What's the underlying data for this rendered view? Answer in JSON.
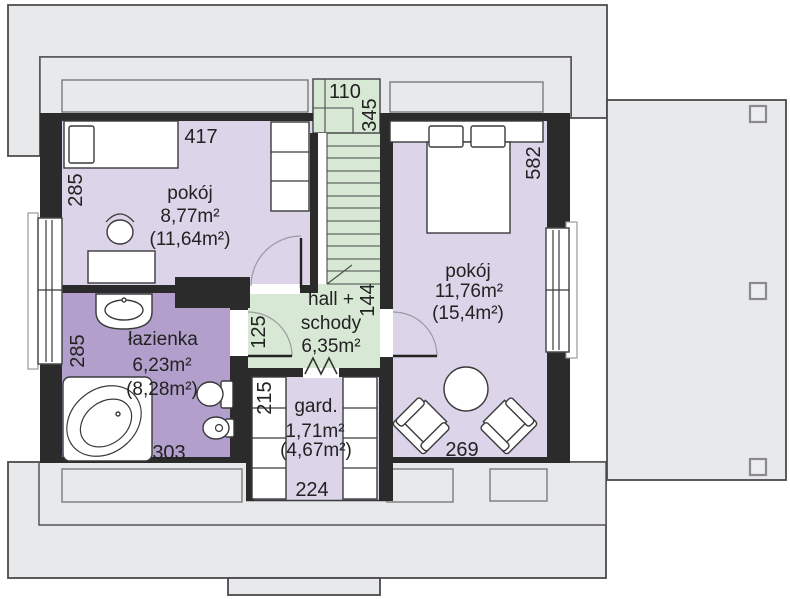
{
  "plan": {
    "rooms": {
      "room1": {
        "name": "pokój",
        "area": "8,77m²",
        "area_gross": "(11,64m²)"
      },
      "bathroom": {
        "name": "łazienka",
        "area": "6,23m²",
        "area_gross": "(8,28m²)"
      },
      "hall": {
        "line1": "hall +",
        "line2": "schody",
        "area": "6,35m²"
      },
      "wardrobe": {
        "name": "gard.",
        "area": "1,71m²",
        "area_gross": "(4,67m²)"
      },
      "room2": {
        "name": "pokój",
        "area": "11,76m²",
        "area_gross": "(15,4m²)"
      }
    },
    "dims": {
      "room1_w": "417",
      "room1_h": "285",
      "stairs_w": "110",
      "stairs_h": "345",
      "bathroom_h": "285",
      "bathroom_w": "303",
      "hall_h": "125",
      "hall_stairs_h": "144",
      "wardrobe_h": "215",
      "wardrobe_w": "224",
      "room2_h": "582",
      "room2_w": "269"
    },
    "colors": {
      "room_fill": "#dcd4e8",
      "bathroom_fill": "#b29fcb",
      "hall_fill": "#d7e8d4",
      "roof_fill": "#e8e9eb",
      "wall": "#2b2b2c"
    }
  }
}
